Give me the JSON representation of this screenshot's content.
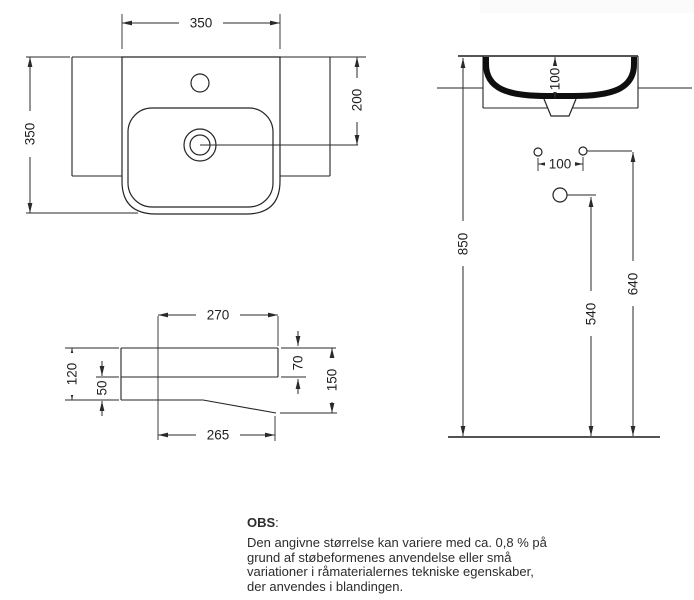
{
  "note": {
    "heading": "OBS",
    "colon": ":",
    "lines": [
      "Den angivne størrelse kan variere med ca. 0,8 % på",
      "grund af støbeformenes anvendelse eller små",
      "variationer i råmaterialernes tekniske egenskaber,",
      "der anvendes i blandingen."
    ]
  },
  "dims": {
    "plan": {
      "width": "350",
      "height": "350",
      "drain_from_top": "200"
    },
    "front": {
      "bowl_depth": "100",
      "hole_spacing": "100",
      "rim_height": "850",
      "outlet_height": "540",
      "holes_height": "640"
    },
    "profile": {
      "top_depth": "270",
      "front_height": "120",
      "bottom_back": "50",
      "apron_height": "70",
      "side_height": "150",
      "bottom_depth": "265"
    }
  },
  "colors": {
    "line": "#242424",
    "text": "#1f1f1f",
    "background": "#ffffff"
  }
}
